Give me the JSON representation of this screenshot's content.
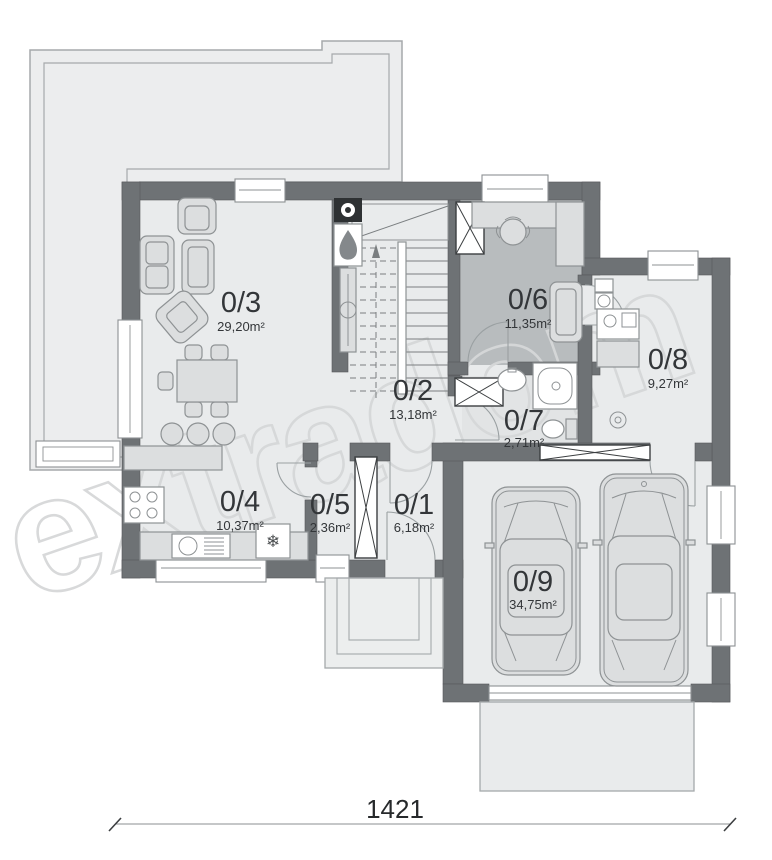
{
  "watermark": "extradom",
  "dimension": "1421",
  "rooms": [
    {
      "id": "0/1",
      "area": "6,18m²"
    },
    {
      "id": "0/2",
      "area": "13,18m²"
    },
    {
      "id": "0/3",
      "area": "29,20m²"
    },
    {
      "id": "0/4",
      "area": "10,37m²"
    },
    {
      "id": "0/5",
      "area": "2,36m²"
    },
    {
      "id": "0/6",
      "area": "11,35m²"
    },
    {
      "id": "0/7",
      "area": "2,71m²"
    },
    {
      "id": "0/8",
      "area": "9,27m²"
    },
    {
      "id": "0/9",
      "area": "34,75m²"
    }
  ],
  "glyphs": {
    "snowflake": "❄"
  },
  "colors": {
    "wall": "#6e7275",
    "floor": "#e9ebec",
    "floor-dark": "#b8bcbe",
    "floor-bath": "#e2e4e5",
    "terrace": "#ecedee",
    "furn": "#dcdedf",
    "watermark": "#d6d8d9",
    "label": "#333639"
  }
}
